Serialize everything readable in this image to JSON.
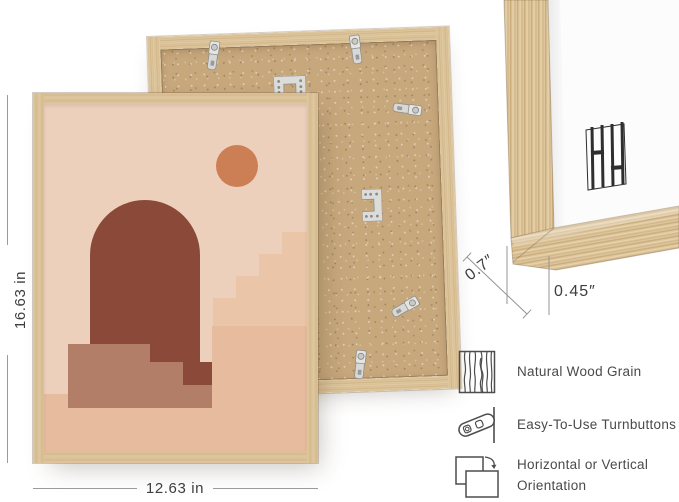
{
  "dimensions": {
    "height": "16.63 in",
    "width": "12.63 in",
    "depth": "0.7″",
    "molding_face": "0.45″"
  },
  "features": {
    "items": [
      {
        "icon": "wood-grain-icon",
        "label": "Natural Wood Grain"
      },
      {
        "icon": "turnbutton-icon",
        "label": "Easy-To-Use Turnbuttons"
      },
      {
        "icon": "orientation-icon",
        "label": "Horizontal or Vertical Orientation"
      }
    ]
  },
  "icons": {
    "hanger": "sawtooth-hanger-icon",
    "hardware": [
      "turnbutton-clip",
      "sawtooth-hanger"
    ]
  },
  "colors": {
    "wood": "#DCC49C",
    "mdf_back": "#C7A77C",
    "canvas_white": "#FCFCFC",
    "art_background": "#ECD0BC",
    "art_arch": "#8B4A39",
    "art_sun": "#CC7E55",
    "art_stairs_light": "#EAC5A8",
    "art_stairs_mid": "#B27E68",
    "art_ground": "#E7BC9E",
    "annotation_line": "#9B9B9B",
    "annotation_text": "#3E3E3E"
  }
}
